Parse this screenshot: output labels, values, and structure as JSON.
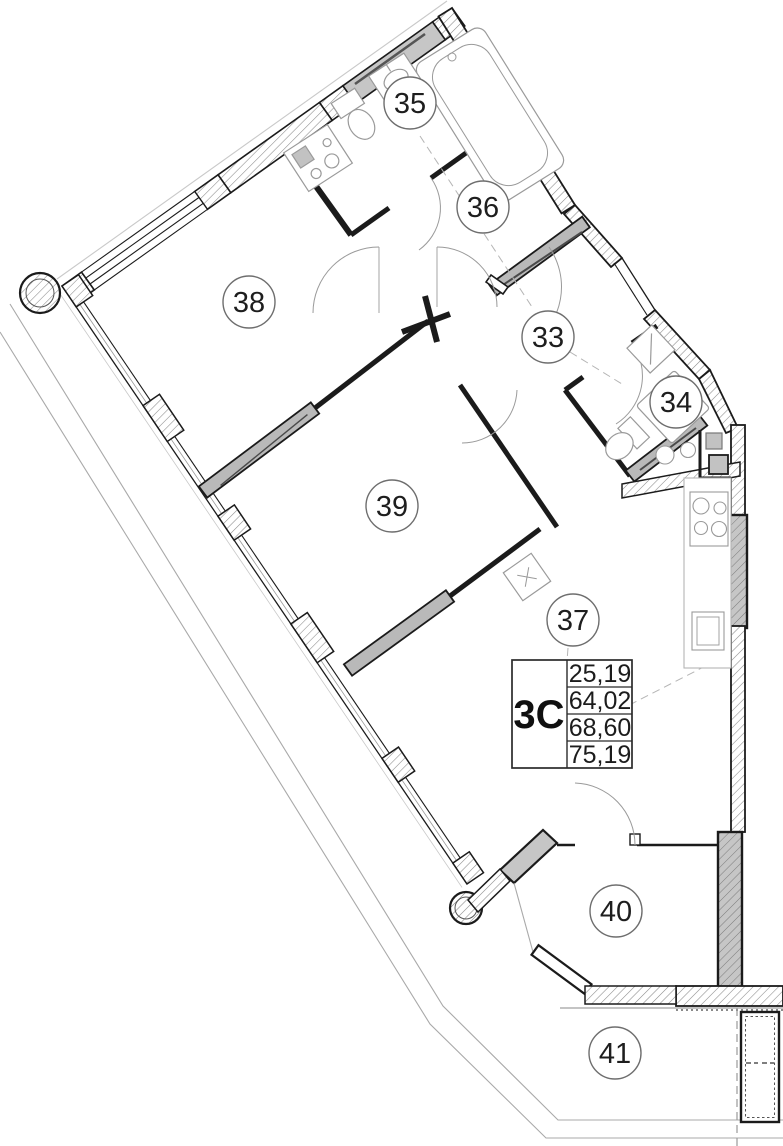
{
  "plan": {
    "title": "apartment-floor-plan",
    "unit_type": {
      "label": "3C"
    },
    "area_values": [
      "25,19",
      "64,02",
      "68,60",
      "75,19"
    ],
    "rooms": [
      {
        "number": "35"
      },
      {
        "number": "36"
      },
      {
        "number": "38"
      },
      {
        "number": "33"
      },
      {
        "number": "34"
      },
      {
        "number": "39"
      },
      {
        "number": "37"
      },
      {
        "number": "40"
      },
      {
        "number": "41"
      }
    ],
    "icons": [
      "bathtub-icon",
      "sink-icon",
      "toilet-icon",
      "washing-machine-icon",
      "stove-icon",
      "kitchen-sink-icon",
      "door-arc-icon",
      "column-icon",
      "vent-shaft-icon"
    ],
    "colors": {
      "wall": "#1b1b1b",
      "partition_fill": "#b9b9b9",
      "window_fill": "#c6c6c6",
      "hatch_line": "#8a8a8a",
      "fixture_line": "#9a9a9a",
      "boundary_line": "#a9a9a9",
      "label_text": "#1e1e1e"
    }
  }
}
